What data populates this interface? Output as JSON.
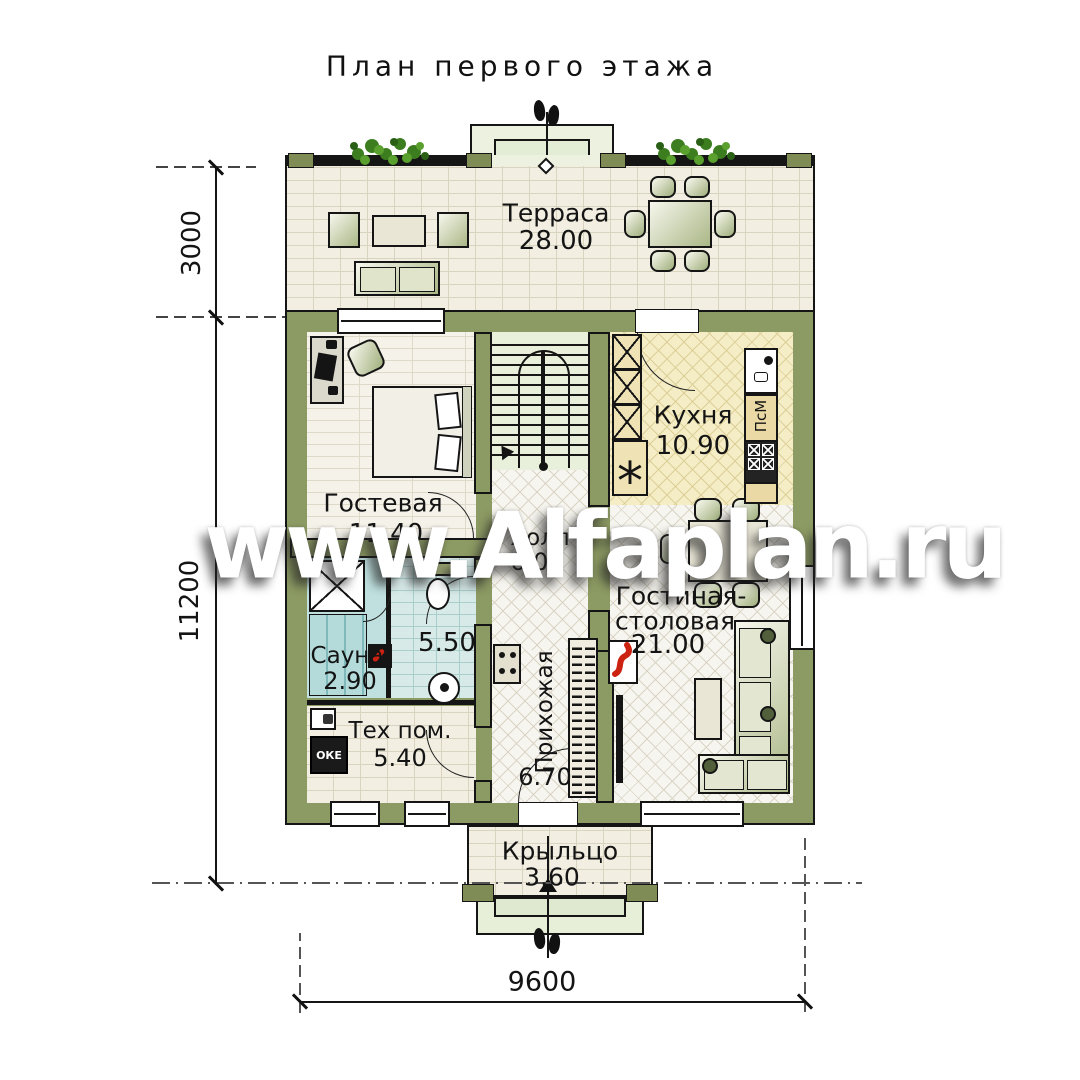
{
  "title": "План первого этажа",
  "watermark": "www.Alfaplan.ru",
  "rooms": {
    "terrace": {
      "name": "Терраса",
      "area": "28.00"
    },
    "guest": {
      "name": "Гостевая",
      "area": "11.40"
    },
    "kitchen": {
      "name": "Кухня",
      "area": "10.90"
    },
    "hall": {
      "name": "Холл",
      "area": "6.00"
    },
    "bathroom": {
      "area": "5.50"
    },
    "sauna": {
      "name": "Сауна",
      "area": "2.90"
    },
    "tech": {
      "name": "Тех пом.",
      "area": "5.40"
    },
    "hallway": {
      "name": "Прихожая",
      "area": "6.70"
    },
    "living": {
      "name_line1": "Гостиная-",
      "name_line2": "столовая",
      "area": "21.00"
    },
    "porch": {
      "name": "Крыльцо",
      "area": "3.60"
    }
  },
  "dimensions": {
    "terrace_depth": "3000",
    "total_depth": "11200",
    "width": "9600"
  },
  "equipment": {
    "dishwasher": "ПсМ",
    "boiler": "ОКЕ",
    "fridge_symbol": "*"
  },
  "colors": {
    "wall_olive": "#8c9a63",
    "line_black": "#151515",
    "kitchen_floor": "#f4edc6",
    "bath_floor": "#d7eae8",
    "terrace_floor": "#f2efe2",
    "stairs_floor": "#e8efda",
    "watermark_white": "#ffffff",
    "flame_red": "#cc2211"
  }
}
